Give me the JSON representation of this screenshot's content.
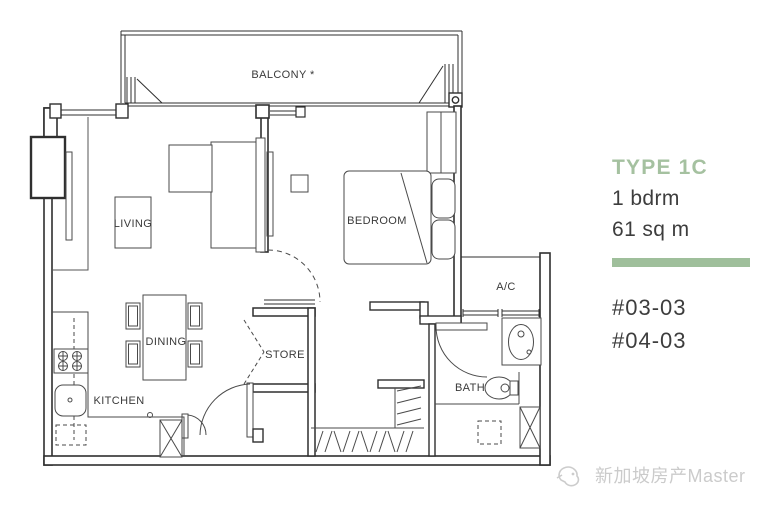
{
  "floor_plan": {
    "rooms": {
      "balcony": "BALCONY *",
      "living": "LIVING",
      "bedroom": "BEDROOM",
      "ac_ledge": "A/C",
      "dining": "DINING",
      "store": "STORE",
      "kitchen": "KITCHEN",
      "bath": "BATH"
    }
  },
  "info_panel": {
    "type_label": "TYPE 1C",
    "bedroom_count": "1 bdrm",
    "area": "61 sq m",
    "accent_color": "#9fbf9b",
    "unit_numbers": [
      "#03-03",
      "#04-03"
    ]
  },
  "watermark": {
    "text": "新加坡房产Master"
  }
}
